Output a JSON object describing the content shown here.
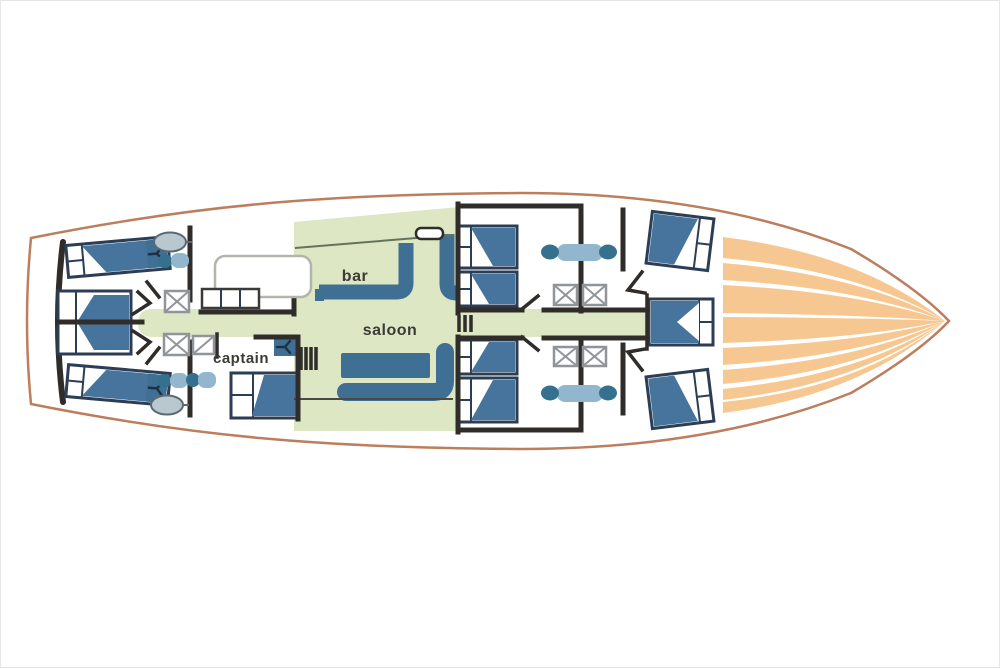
{
  "colors": {
    "hull": "#bd7e5e",
    "wall": "#2f2c29",
    "green": "#dde7c3",
    "orange": "#f6c791",
    "furniture_blue": "#3f7093",
    "bed_blue": "#47749c",
    "bed_outline": "#2c3e55",
    "box_grey": "#90959a",
    "sink_fill": "#b9c7cf",
    "sink_stroke": "#5a6a74",
    "wc_light": "#92b6ce",
    "wc_dark": "#35708f",
    "line_thin": "#66735c",
    "text": "#3b3b37"
  },
  "labels": {
    "bar": "bar",
    "saloon": "saloon",
    "captain": "captain"
  }
}
